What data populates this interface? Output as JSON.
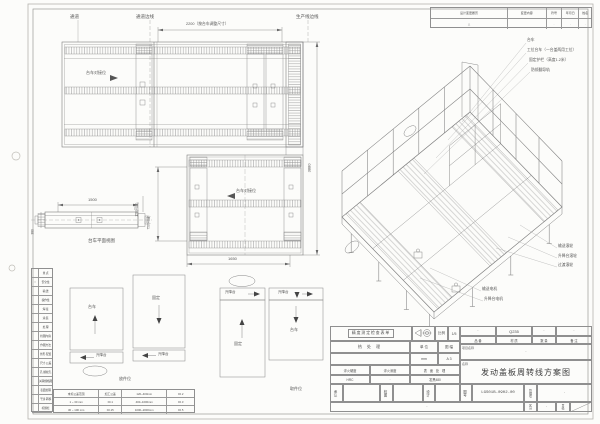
{
  "colors": {
    "paper": "#ffffff",
    "line": "#7d7d7d",
    "text": "#4f4f4f",
    "background": "#f0efec"
  },
  "plan_top": {
    "passage": "通道",
    "passage_edge": "通道边线",
    "dim_width": "2200（按台车调整尺寸）",
    "prod_edge": "生产线边线",
    "dock": "台车对接位",
    "dim_height": "3880"
  },
  "plan_mid": {
    "dock": "台车对接位",
    "dim_width": "1650",
    "dim_left": "750(可调)"
  },
  "side_view": {
    "dim_width": "1500",
    "dim_height": "380",
    "dim_adj": "150(可调)",
    "caption": "台车平面视图"
  },
  "positions": {
    "trolley": "台车",
    "fixed": "固定",
    "lift": "升降台",
    "place": "放件位",
    "pick": "取件位"
  },
  "callouts": {
    "top": [
      "台车",
      "工位台车（一台盖两用工位）",
      "固定护栏（高度1.2米）",
      "防倾翻导轨"
    ],
    "right": [
      "输送滚轮",
      "升降台滚轮",
      "过渡滚轮"
    ],
    "bottom": [
      "输送电机",
      "升降台电机"
    ]
  },
  "checklist": {
    "rows": [
      {
        "mark": "",
        "label": "重 点"
      },
      {
        "mark": "○",
        "label": "安全性"
      },
      {
        "mark": "",
        "label": "输 送"
      },
      {
        "mark": "",
        "label": "操作性"
      },
      {
        "mark": "",
        "label": "焊 接"
      },
      {
        "mark": "",
        "label": "涂 装"
      },
      {
        "mark": "",
        "label": "处 理"
      },
      {
        "mark": "",
        "label": "检图内容"
      },
      {
        "mark": "",
        "label": "作图方法"
      },
      {
        "mark": "",
        "label": "外形·配置"
      },
      {
        "mark": "",
        "label": "尺寸·公差"
      },
      {
        "mark": "",
        "label": "孔·螺纹孔"
      },
      {
        "mark": "",
        "label": "关联规格图"
      },
      {
        "mark": "",
        "label": "表面处理"
      },
      {
        "mark": "",
        "label": "干涉·转移"
      },
      {
        "mark": "",
        "label": "标题栏"
      }
    ]
  },
  "tolerance": {
    "rows": [
      [
        "未标公差范围",
        "加工公差",
        "120~400mm",
        "±0.2"
      ],
      [
        "1 ~ 30 mm",
        "±0.1",
        "400~1000mm",
        "±0.3"
      ],
      [
        "30 ~ 100 mm",
        "±0.15",
        "1000~2000mm",
        "±0.5"
      ]
    ]
  },
  "revision": {
    "headers": [
      "设计变更履历",
      "变更内容",
      "符号",
      "年月日",
      "姓名"
    ],
    "row": [
      "△",
      "",
      "·",
      "·",
      "·"
    ]
  },
  "titleblock": {
    "checklist_box": "精度测定检查表单",
    "scale_label": "比例",
    "scale_value": "1/5",
    "heat_label": "热 处 理",
    "unit_label": "单 位",
    "unit_value": "mm",
    "format_label": "图 幅",
    "format_value": "A 3",
    "quench_hardness_label": "淬火硬度",
    "quench_hardness_value": "HRC",
    "quench_depth_label": "淬火深度",
    "quench_depth_value": "·",
    "surface_label": "表 面 处 理",
    "surface_value": "发黑480",
    "part_label": "品 番",
    "part_value": "·",
    "material_label": "材 质",
    "material_value": "Q235",
    "qty_label": "数 量",
    "qty_value": "·",
    "remark_label": "备 注",
    "remark_value": "·",
    "project_label": "项目名称",
    "project_value": "·",
    "name_label": "名称",
    "name_value": "发动盖板周转线方案图",
    "approve_label": "承认",
    "review_label": "校图",
    "design_label": "设计",
    "dwgno_label": "图号",
    "dwgno_value": "LGS01B-0902-00",
    "manage_label": "管理号",
    "manage_value": "·",
    "class_label": "区分",
    "class_value": "·",
    "page_label": "页码",
    "bottom_note": "·"
  }
}
